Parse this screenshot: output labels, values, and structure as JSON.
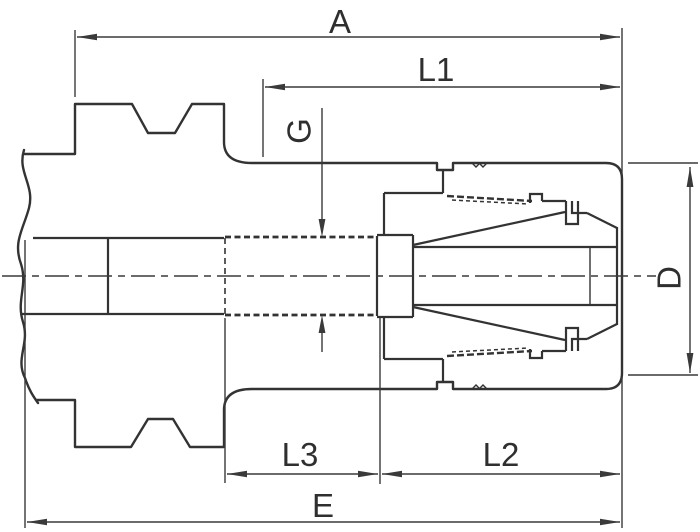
{
  "drawing_type": "dimensioned technical section drawing",
  "labels": {
    "a": "A",
    "l1": "L1",
    "g": "G",
    "d": "D",
    "l3": "L3",
    "l2": "L2",
    "e": "E"
  },
  "dimension_labels_visible": [
    "A",
    "L1",
    "G",
    "D",
    "L3",
    "L2",
    "E"
  ],
  "colors": {
    "line": "#333333",
    "dim": "#3a3a3a",
    "text": "#2f2f2f",
    "background": "#ffffff"
  }
}
